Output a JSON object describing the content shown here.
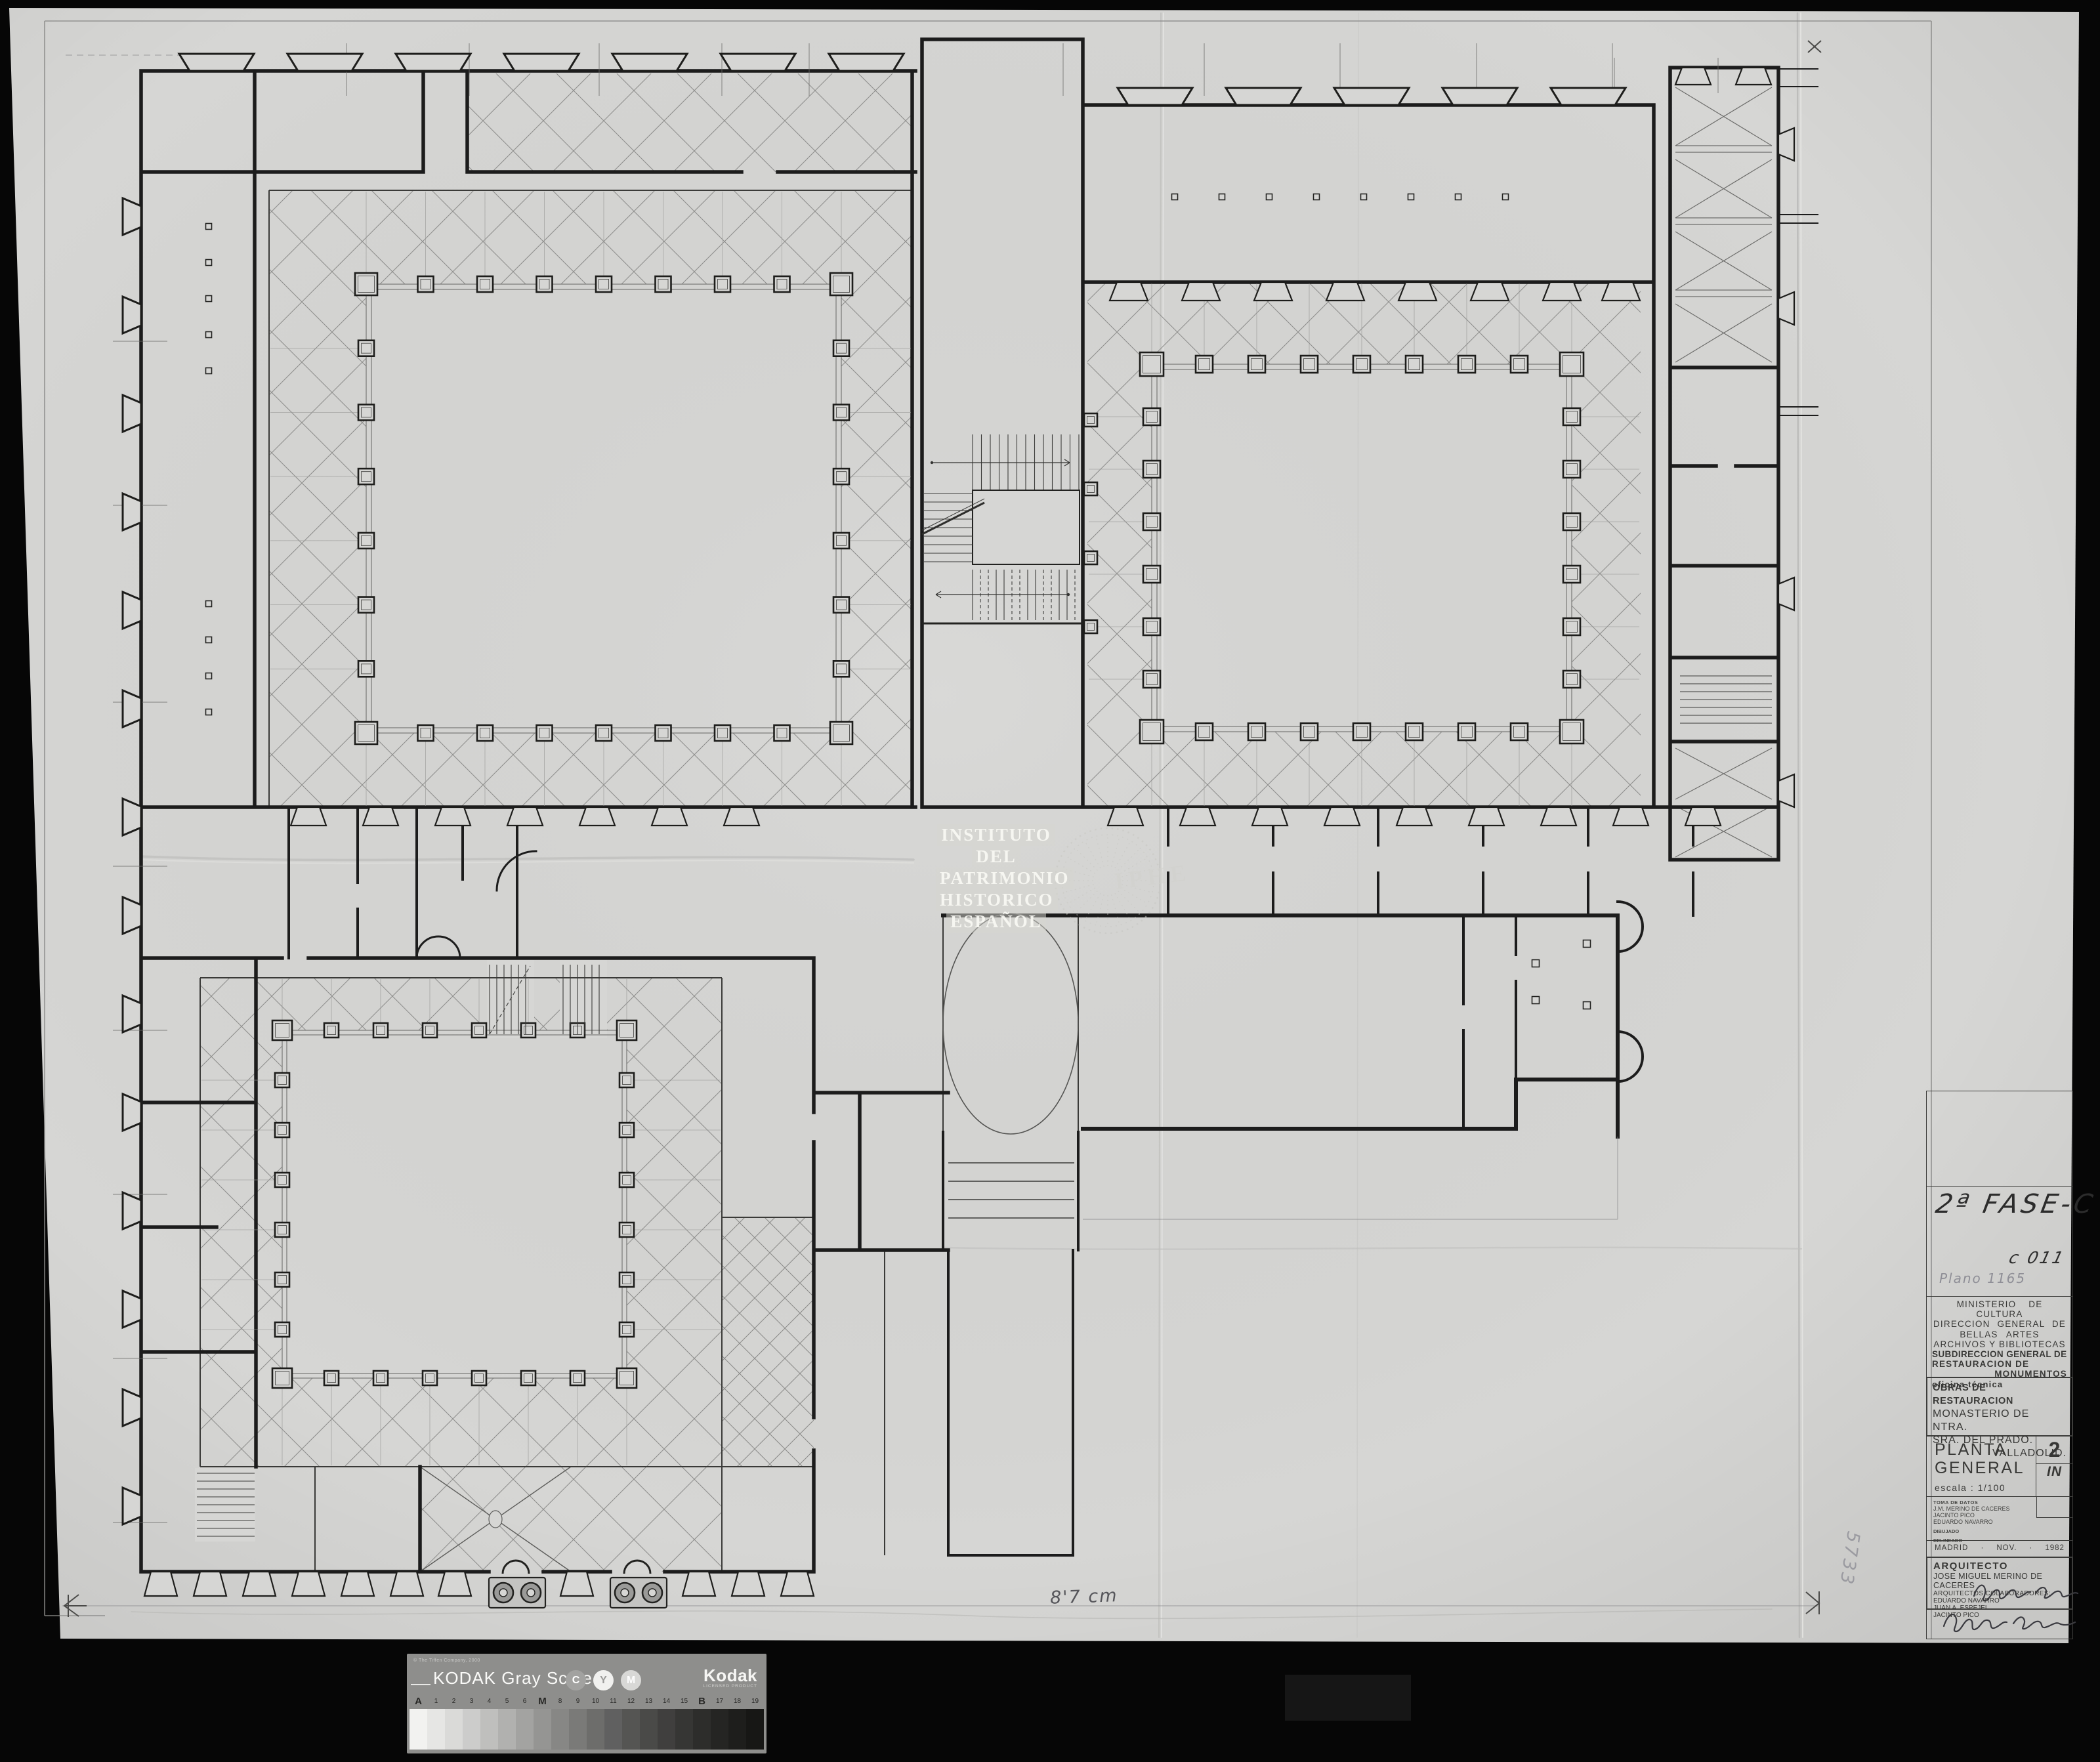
{
  "annotations": {
    "phase": "2ª FASE-C",
    "code": "c 011",
    "pencil_plan_number": "Plano 1165",
    "pencil_vertical": "5733",
    "measure_note": "8'7 cm"
  },
  "stamps": {
    "watermark_lines": [
      "INSTITUTO",
      "DEL",
      "PATRIMONIO",
      "HISTORICO",
      "ESPAÑOL"
    ],
    "round_stamp_text": "IPHE"
  },
  "title_block": {
    "ministry_lines": [
      "MINISTERIO  DE  CULTURA",
      "DIRECCION  GENERAL  DE",
      "BELLAS  ARTES",
      "ARCHIVOS  Y  BIBLIOTECAS"
    ],
    "subdirection_lines": [
      "SUBDIRECCION GENERAL DE",
      "RESTAURACION DE",
      "MONUMENTOS"
    ],
    "office": "oficina técnica",
    "works_title": "OBRAS DE RESTAURACION",
    "monument_lines": [
      "MONASTERIO DE NTRA.",
      "SRA. DEL PRADO."
    ],
    "city": "VALLADOLID.",
    "sheet_title_line1": "PLANTA",
    "sheet_title_line2": "GENERAL",
    "sheet_number": "2",
    "sheet_number_suffix": "IN",
    "scale_label": "escala : 1/100",
    "toma_label": "TOMA DE DATOS",
    "toma_names": [
      "J.M. MERINO DE CACERES",
      "JACINTO PICO",
      "EDUARDO NAVARRO"
    ],
    "dibujado_label": "DIBUJADO",
    "delineado_label": "DELINEADO",
    "place": "MADRID",
    "dot1": "·",
    "month": "NOV.",
    "dot2": "·",
    "year": "1982",
    "architect_label": "ARQUITECTO",
    "architect_name": "JOSE MIGUEL MERINO DE CACERES",
    "collaborators_label": "ARQUITECTOS COLABORADORES:",
    "collaborators": [
      "EDUARDO NAVARRO",
      "JUAN A. ESPEJEL",
      "JACINTO PICO"
    ]
  },
  "gray_scale": {
    "copyright": "© The Tiffen Company, 2000",
    "brand": "KODAK Gray Scale",
    "kodak_logo": "Kodak",
    "licensed": "LICENSED PRODUCT",
    "cym": [
      {
        "letter": "C",
        "bg": "#a2a2a0",
        "fg": "#ffffff"
      },
      {
        "letter": "Y",
        "bg": "#f1f1ef",
        "fg": "#9b9b99"
      },
      {
        "letter": "M",
        "bg": "#d8d8d6",
        "fg": "#fdfdfd"
      }
    ],
    "patch_labels": [
      "A",
      "1",
      "2",
      "3",
      "4",
      "5",
      "6",
      "M",
      "8",
      "9",
      "10",
      "11",
      "12",
      "13",
      "14",
      "15",
      "B",
      "17",
      "18",
      "19"
    ],
    "patch_colors": [
      "#f2f2f0",
      "#e6e6e4",
      "#dadad8",
      "#cccccb",
      "#bfbfbd",
      "#b1b1af",
      "#a3a3a1",
      "#959593",
      "#878785",
      "#7a7a78",
      "#6d6d6b",
      "#606060",
      "#555553",
      "#4a4a48",
      "#403f3e",
      "#363634",
      "#2d2d2b",
      "#252523",
      "#1e1e1c",
      "#171715"
    ]
  },
  "colors": {
    "paper": "#d6d6d4",
    "ink": "#1c1c1c",
    "pencil": "#8e8e96",
    "scanner_bed": "#060606",
    "kodak_bg": "#8e8e8c"
  }
}
